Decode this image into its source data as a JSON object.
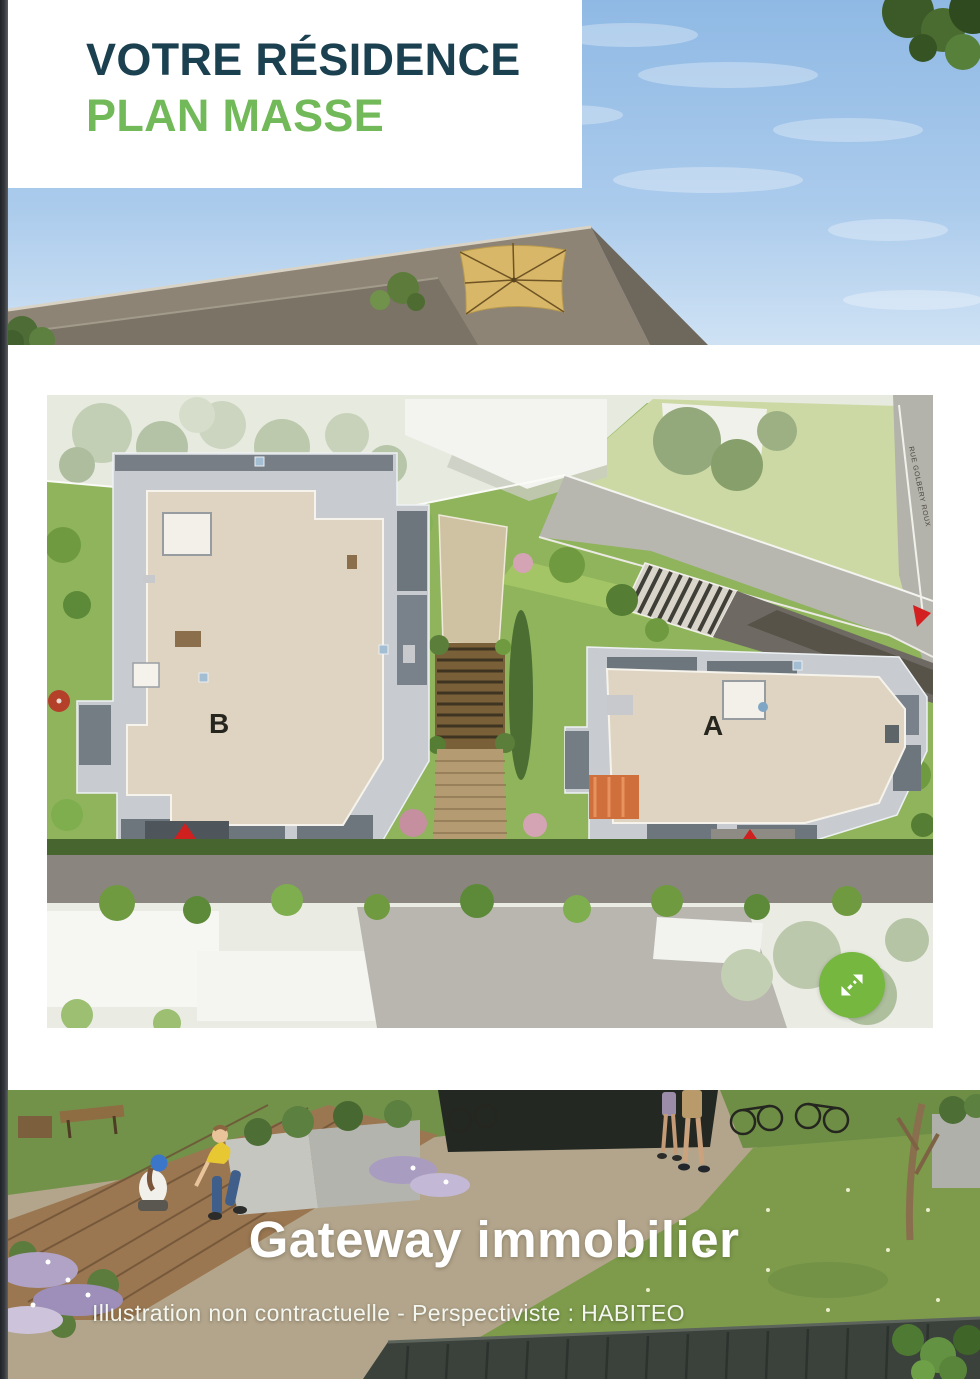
{
  "header": {
    "title": "VOTRE RÉSIDENCE",
    "subtitle": "PLAN MASSE"
  },
  "site_plan": {
    "building_labels": [
      "B",
      "A"
    ],
    "hall_label": "HALL",
    "street_label": "RUE GOLBERY ROUX"
  },
  "expand_button": {
    "icon": "expand-arrows-icon"
  },
  "footer": {
    "brand": "Gateway immobilier",
    "disclaimer": "Illustration non contractuelle - Perspectiviste : HABITEO"
  },
  "colors": {
    "title_dark": "#1b4050",
    "accent_green": "#72b959",
    "fab_green": "#76b740",
    "marker_red": "#cf1f1f"
  }
}
